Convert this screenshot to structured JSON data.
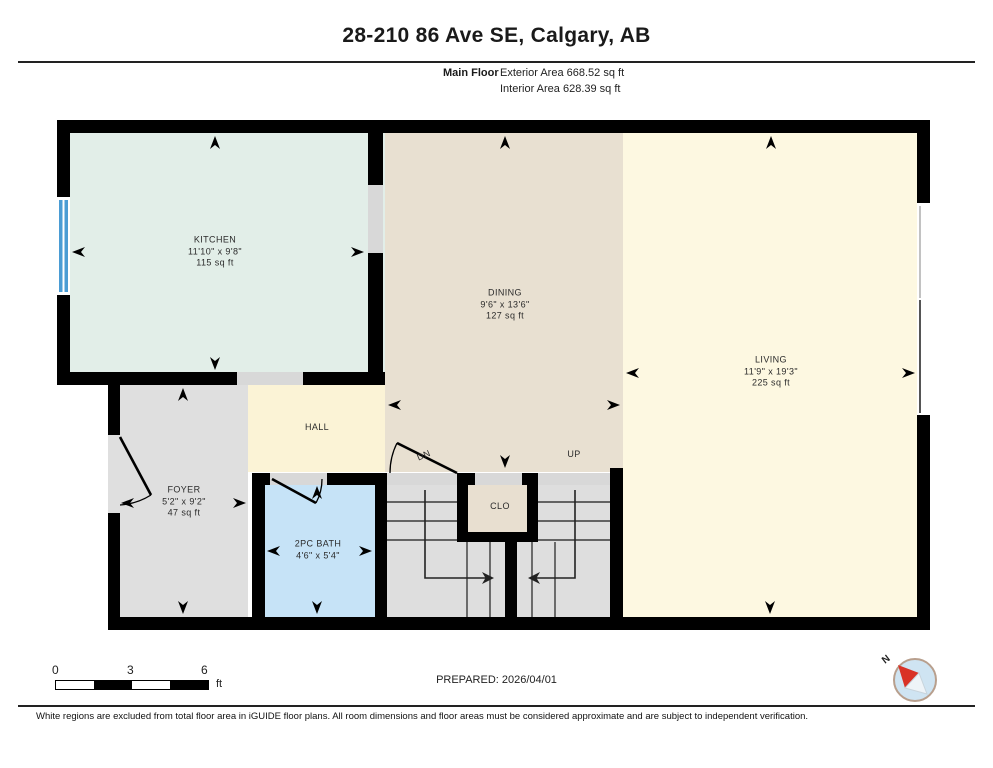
{
  "header": {
    "title": "28-210 86 Ave SE, Calgary, AB",
    "floor_label": "Main Floor",
    "exterior_area": "Exterior Area 668.52 sq ft",
    "interior_area": "Interior Area 628.39 sq ft"
  },
  "rooms": {
    "kitchen": {
      "name": "KITCHEN",
      "dims": "11'10\" x 9'8\"",
      "area": "115 sq ft"
    },
    "dining": {
      "name": "DINING",
      "dims": "9'6\" x 13'6\"",
      "area": "127 sq ft"
    },
    "living": {
      "name": "LIVING",
      "dims": "11'9\" x 19'3\"",
      "area": "225 sq ft"
    },
    "foyer": {
      "name": "FOYER",
      "dims": "5'2\" x 9'2\"",
      "area": "47 sq ft"
    },
    "bath": {
      "name": "2PC BATH",
      "dims": "4'6\" x 5'4\""
    },
    "hall": {
      "name": "HALL"
    },
    "closet": {
      "name": "CLO"
    },
    "stairs": {
      "up": "UP",
      "down": "DN"
    }
  },
  "footer": {
    "scale": {
      "start": "0",
      "mid": "3",
      "end": "6",
      "unit": "ft"
    },
    "prepared": "PREPARED: 2026/04/01",
    "compass_label": "N",
    "disclaimer": "White regions are excluded from total floor area in iGUIDE floor plans. All room dimensions and floor areas must be considered approximate and are subject to independent verification."
  },
  "colors": {
    "kitchen": "#e2eee8",
    "dining": "#e8e0d1",
    "living": "#fdf8e1",
    "hall": "#fbf3d6",
    "foyer": "#dfdfdf",
    "bath": "#c6e3f7",
    "closet": "#e8dfd0",
    "stairs": "#dedede",
    "opening": "#d8d8d8",
    "wall": "#000000",
    "window_blue": "#4a9cd4",
    "compass_fill": "#cfe4f2",
    "compass_red": "#d93226",
    "scale_black": "#000000"
  }
}
